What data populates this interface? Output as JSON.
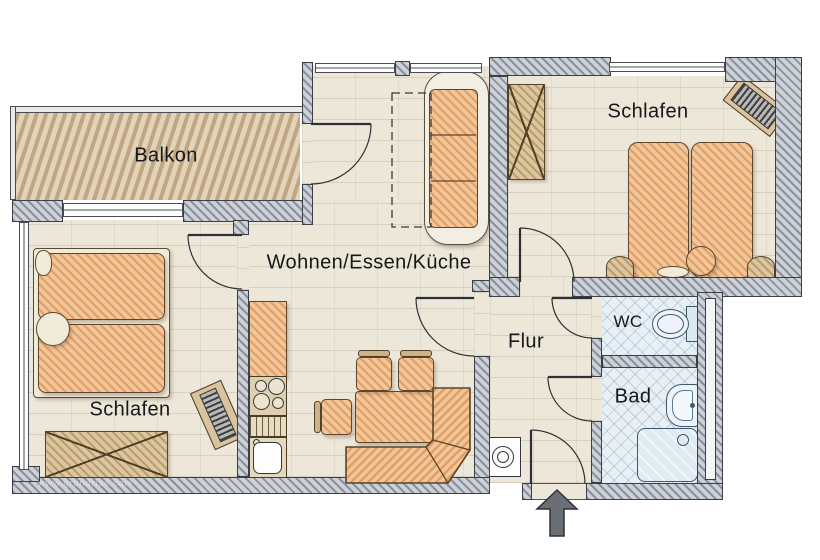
{
  "rooms": {
    "balcony": {
      "label": "Balkon"
    },
    "bedroom_left": {
      "label": "Schlafen"
    },
    "bedroom_right": {
      "label": "Schlafen"
    },
    "living": {
      "label": "Wohnen/Essen/Küche"
    },
    "hallway": {
      "label": "Flur"
    },
    "wc": {
      "label": "WC"
    },
    "bathroom": {
      "label": "Bad"
    }
  },
  "watermark": "www.grundriss.com",
  "entrance_direction": "up",
  "icons": [
    "double-bed",
    "nightstand",
    "wardrobe",
    "radiator",
    "sofa",
    "rug-outline",
    "dining-table",
    "chair",
    "corner-bench",
    "kitchen-counter",
    "stove",
    "drainboard",
    "kitchen-sink",
    "washing-machine",
    "toilet",
    "washbasin",
    "shower",
    "entrance-arrow",
    "door-swing",
    "window"
  ],
  "colors": {
    "wall_fill": "#cdd1d8",
    "wall_hatch": "#8a919c",
    "floor": "#ece7d9",
    "balcony_hatch": "#c2a683",
    "furniture_accent": "#e8b183",
    "wood": "#d2b488",
    "tile": "#e9f0f5",
    "sanitary": "#edf3f8",
    "label_color": "#17181a"
  }
}
